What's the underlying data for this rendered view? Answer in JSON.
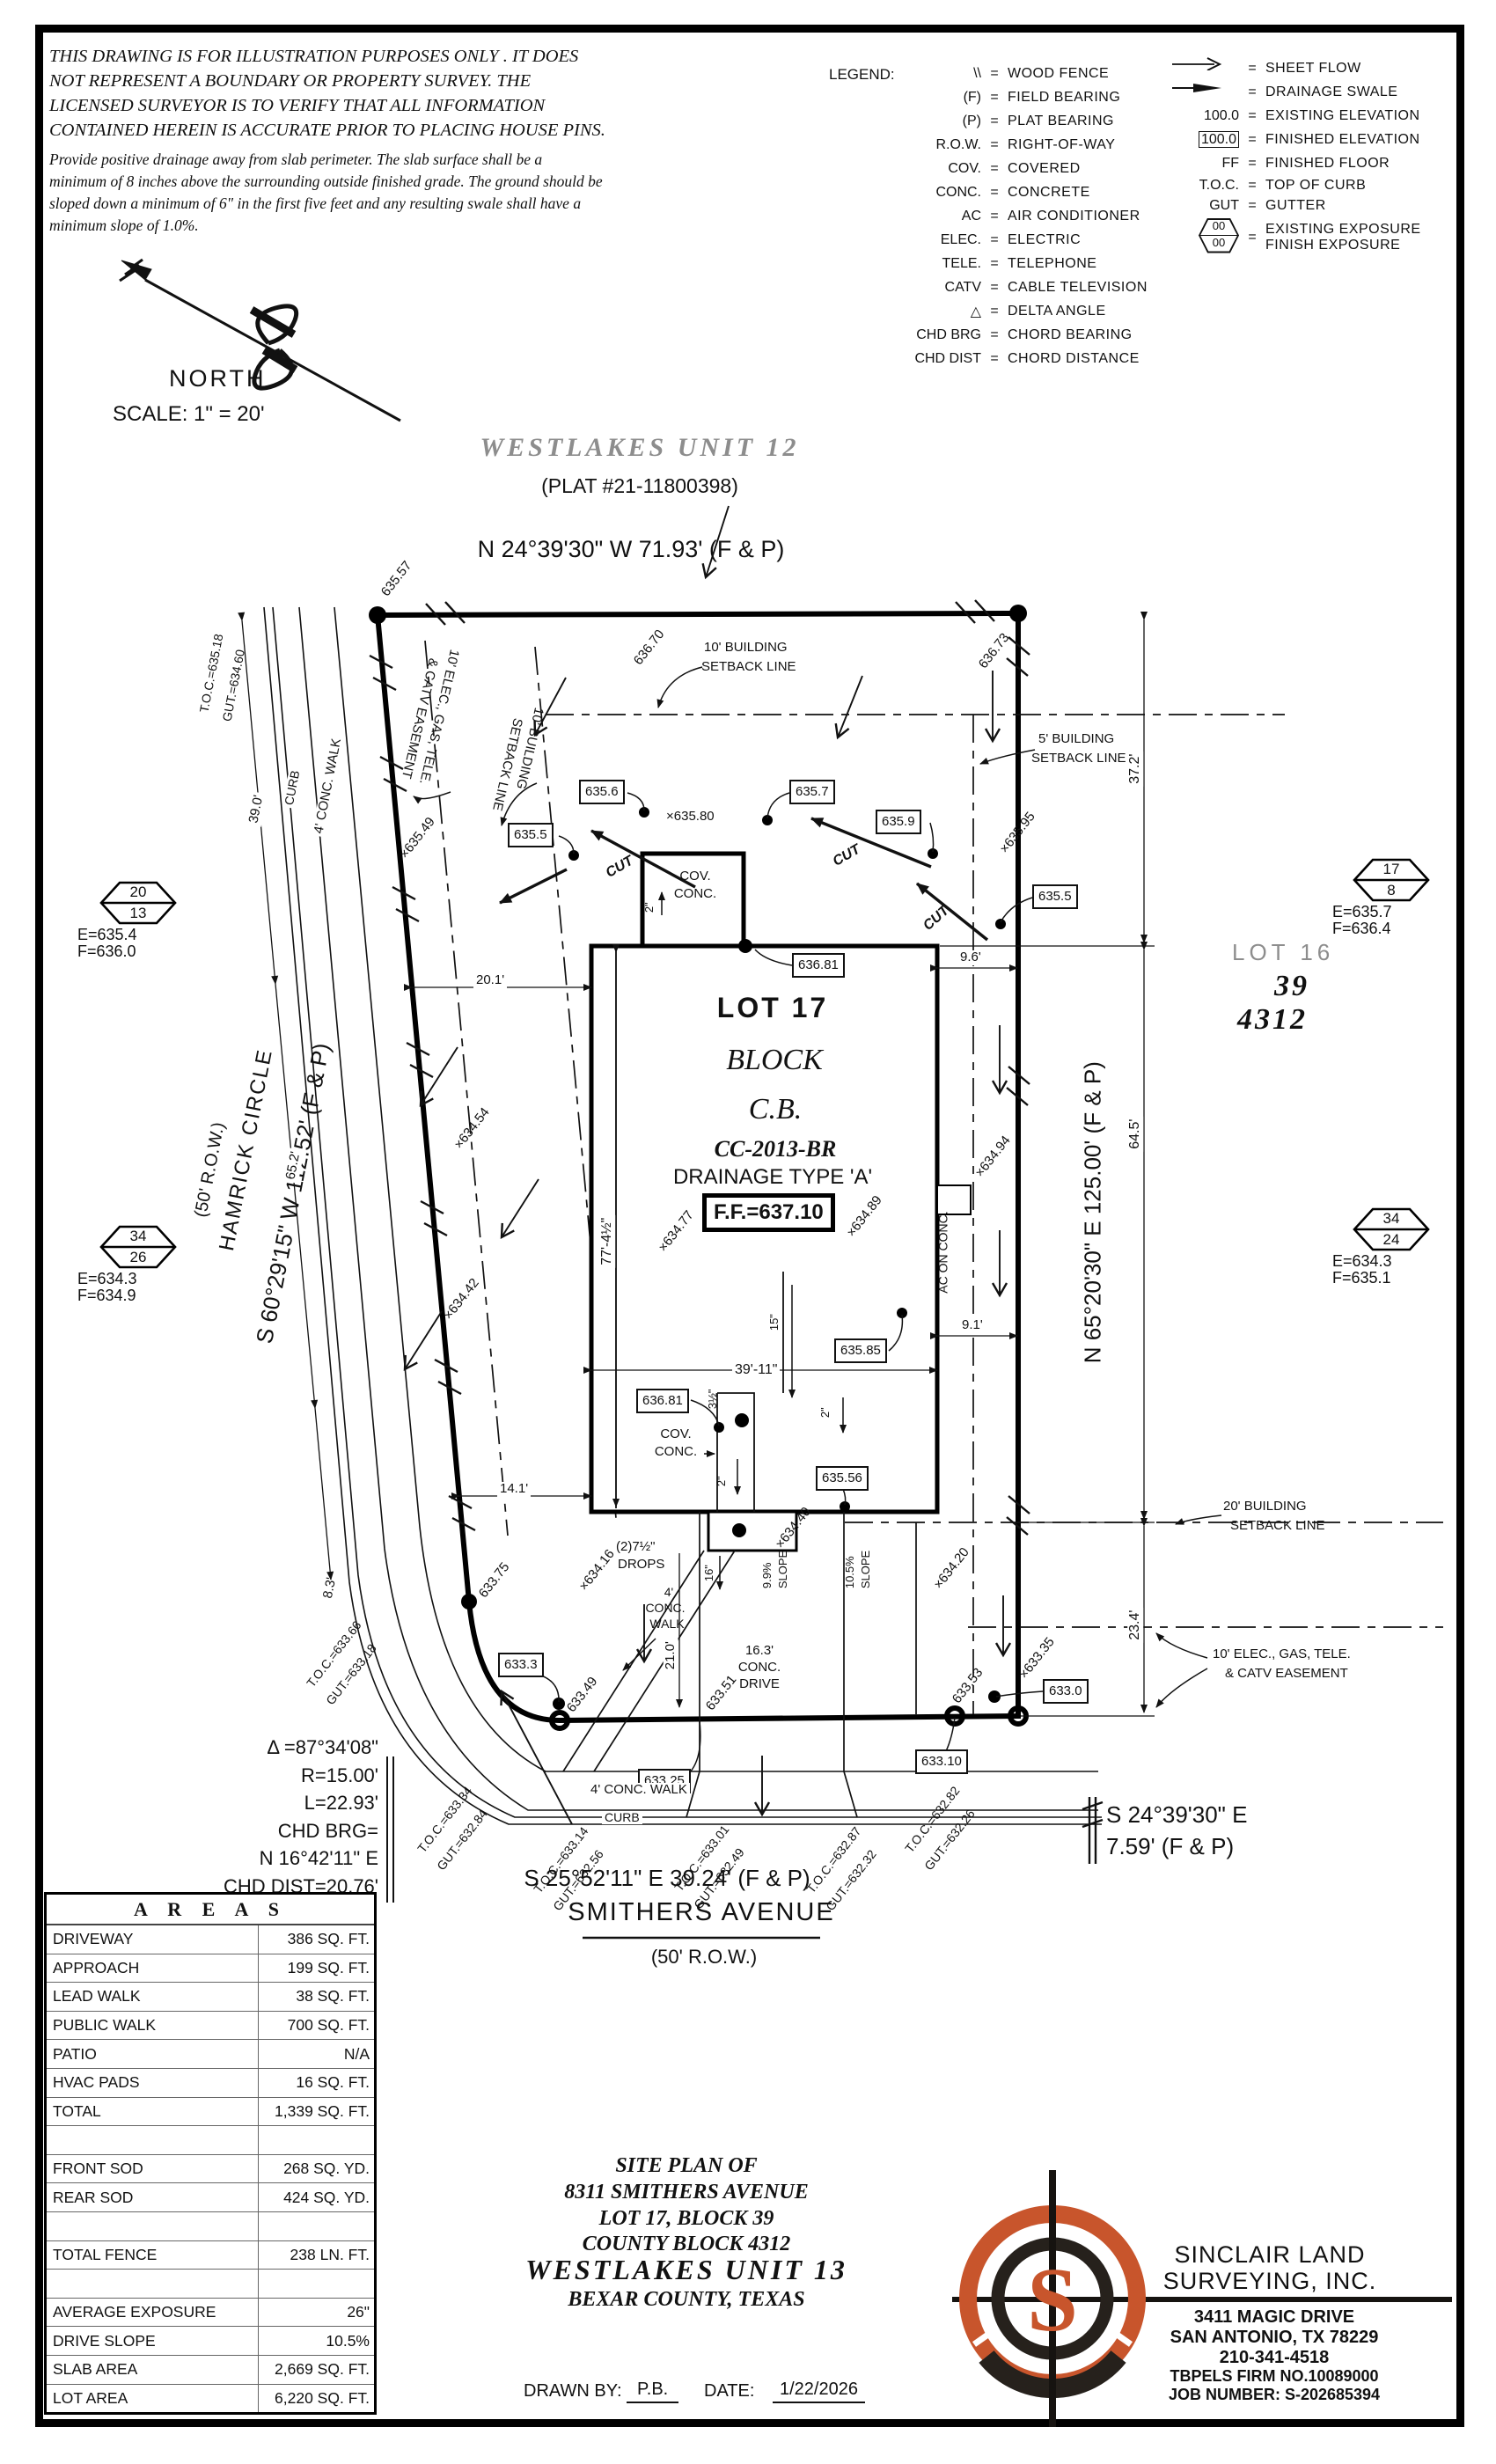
{
  "colors": {
    "accent": "#c8552c",
    "ink": "#111111",
    "gray_text": "#8d8d8d"
  },
  "disclaimer": {
    "lines": [
      "THIS DRAWING IS FOR ILLUSTRATION PURPOSES ONLY . IT DOES",
      "NOT REPRESENT A BOUNDARY OR PROPERTY SURVEY. THE",
      "LICENSED SURVEYOR IS TO VERIFY THAT ALL INFORMATION",
      "CONTAINED HEREIN IS ACCURATE PRIOR TO PLACING HOUSE PINS."
    ],
    "note_lines": [
      "Provide positive drainage away from slab perimeter. The slab surface shall be a",
      "minimum of 8 inches above the surrounding outside finished grade. The ground should be",
      "sloped down a minimum of 6\" in the first five feet and any resulting swale shall have a",
      "minimum slope of 1.0%."
    ]
  },
  "north": {
    "label": "NORTH",
    "scale": "SCALE: 1\" = 20'"
  },
  "legend": {
    "title": "LEGEND:",
    "eq": "=",
    "left": [
      {
        "sym": "\\\\",
        "desc": "WOOD FENCE"
      },
      {
        "sym": "(F)",
        "desc": "FIELD BEARING"
      },
      {
        "sym": "(P)",
        "desc": "PLAT BEARING"
      },
      {
        "sym": "R.O.W.",
        "desc": "RIGHT-OF-WAY"
      },
      {
        "sym": "COV.",
        "desc": "COVERED"
      },
      {
        "sym": "CONC.",
        "desc": "CONCRETE"
      },
      {
        "sym": "AC",
        "desc": "AIR CONDITIONER"
      },
      {
        "sym": "ELEC.",
        "desc": "ELECTRIC"
      },
      {
        "sym": "TELE.",
        "desc": "TELEPHONE"
      },
      {
        "sym": "CATV",
        "desc": "CABLE TELEVISION"
      },
      {
        "sym": "△",
        "desc": "DELTA ANGLE"
      },
      {
        "sym": "CHD BRG",
        "desc": "CHORD BEARING"
      },
      {
        "sym": "CHD DIST",
        "desc": "CHORD DISTANCE"
      }
    ],
    "right": [
      {
        "desc": "SHEET FLOW"
      },
      {
        "desc": "DRAINAGE SWALE"
      },
      {
        "sym": "100.0",
        "desc": "EXISTING ELEVATION"
      },
      {
        "sym": "100.0",
        "desc": "FINISHED ELEVATION"
      },
      {
        "sym": "FF",
        "desc": "FINISHED FLOOR"
      },
      {
        "sym": "T.O.C.",
        "desc": "TOP OF CURB"
      },
      {
        "sym": "GUT",
        "desc": "GUTTER"
      },
      {
        "sym_top": "00",
        "sym_bottom": "00",
        "desc1": "EXISTING EXPOSURE",
        "desc2": "FINISH EXPOSURE"
      }
    ]
  },
  "header": {
    "subdivision": "WESTLAKES UNIT 12",
    "plat": "(PLAT #21-11800398)",
    "bearing_top": "N 24°39'30\" W 71.93' (F & P)"
  },
  "west_street": {
    "name": "HAMRICK CIRCLE",
    "row": "(50' R.O.W.)",
    "bearing": "S 60°29'15\" W 112.52' (F & P)"
  },
  "east_bearing": "N 65°20'30\" E 125.00' (F & P)",
  "south_street": {
    "bearing": "S 25°52'11\" E 39.24' (F & P)",
    "name": "SMITHERS AVENUE",
    "row": "(50' R.O.W.)"
  },
  "se_bearing": {
    "line1": "S 24°39'30\" E",
    "line2": "7.59' (F & P)"
  },
  "curve": {
    "delta": "Δ =87°34'08\"",
    "radius": "R=15.00'",
    "length": "L=22.93'",
    "chd_brg_label": "CHD BRG=",
    "chd_brg": "N 16°42'11\" E",
    "chd_dist": "CHD DIST=20.76'"
  },
  "lot17": {
    "name": "LOT 17",
    "block": "BLOCK",
    "cb": "C.B.",
    "plan_code": "CC-2013-BR",
    "drainage": "DRAINAGE TYPE 'A'",
    "finished_floor": "F.F.=637.10"
  },
  "lot16": {
    "name": "LOT 16",
    "block": "39",
    "cb": "4312"
  },
  "markers": [
    {
      "top": "20",
      "bottom": "13",
      "existing": "E=635.4",
      "finish": "F=636.0"
    },
    {
      "top": "34",
      "bottom": "26",
      "existing": "E=634.3",
      "finish": "F=634.9"
    },
    {
      "top": "17",
      "bottom": "8",
      "existing": "E=635.7",
      "finish": "F=636.4"
    },
    {
      "top": "34",
      "bottom": "24",
      "existing": "E=634.3",
      "finish": "F=635.1"
    }
  ],
  "finished_spots": {
    "a635_6": "635.6",
    "a635_5l": "635.5",
    "a635_7": "635.7",
    "a635_9": "635.9",
    "a635_5r": "635.5",
    "a636_81t": "636.81",
    "a635_85": "635.85",
    "a636_81b": "636.81",
    "a635_56": "635.56",
    "a633_3": "633.3",
    "a633_25": "633.25",
    "a633_0": "633.0",
    "a633_10": "633.10"
  },
  "existing_spots": {
    "e635_57": "635.57",
    "e636_70": "636.70",
    "e636_73": "636.73",
    "e635_80": "×635.80",
    "e635_95": "×635.95",
    "e635_49": "×635.49",
    "e634_54": "×634.54",
    "e634_42": "×634.42",
    "e634_77": "×634.77",
    "e634_89": "×634.89",
    "e634_94": "×634.94",
    "e634_16": "×634.16",
    "e634_40": "×634.40",
    "e634_20": "×634.20",
    "e633_75": "633.75",
    "e633_53": "633.53",
    "e633_35": "×633.35",
    "e633_49": "633.49",
    "e633_51": "633.51"
  },
  "toc": {
    "t1": {
      "toc": "T.O.C.=635.18",
      "gut": "GUT.=634.60"
    },
    "t2": {
      "toc": "T.O.C.=633.66",
      "gut": "GUT.=633.18"
    },
    "t3": {
      "toc": "T.O.C.=633.34",
      "gut": "GUT.=632.84"
    },
    "t4": {
      "toc": "T.O.C.=633.14",
      "gut": "GUT.=632.56"
    },
    "t5": {
      "toc": "T.O.C.=633.01",
      "gut": "GUT.=632.49"
    },
    "t6": {
      "toc": "T.O.C.=632.87",
      "gut": "GUT.=632.32"
    },
    "t7": {
      "toc": "T.O.C.=632.82",
      "gut": "GUT.=632.26"
    }
  },
  "dims": {
    "d37_2": "37.2'",
    "d64_5": "64.5'",
    "d23_4": "23.4'",
    "d9_6": "9.6'",
    "d9_1": "9.1'",
    "d20_1": "20.1'",
    "d14_1": "14.1'",
    "d8_3": "8.3'",
    "d39_0": "39.0'",
    "d65_2": "65.2'",
    "d77": "77'-4½\"",
    "d39_11": "39'-11\"",
    "d15": "15\"",
    "d16": "16\"",
    "d21_0": "21.0'",
    "d2": "2\"",
    "d3h": "3½\"",
    "drops1": "(2)7½\"",
    "drops2": "DROPS",
    "drive1": "16.3'",
    "drive2": "CONC.",
    "drive3": "DRIVE",
    "slope99": "9.9%",
    "slope105": "10.5%",
    "slope_word": "SLOPE"
  },
  "labels": {
    "setback10_1": "10' BUILDING",
    "setback10_2": "SETBACK LINE",
    "setback5_1": "5' BUILDING",
    "setback5_2": "SETBACK LINE",
    "setback20_1": "20' BUILDING",
    "setback20_2": "SETBACK LINE",
    "easement_1": "10' ELEC., GAS, TELE.",
    "easement_2": "& CATV EASEMENT",
    "cov": "COV.",
    "conc": "CONC.",
    "cut": "CUT",
    "ac_on_conc": "AC ON CONC.",
    "walk4": "4' CONC. WALK",
    "curb": "CURB",
    "walk4_1": "4'",
    "walk4_2": "CONC.",
    "walk4_3": "WALK"
  },
  "areas": {
    "title": "A R E A S",
    "rows": [
      [
        "DRIVEWAY",
        "386 SQ. FT."
      ],
      [
        "APPROACH",
        "199 SQ. FT."
      ],
      [
        "LEAD WALK",
        "38 SQ. FT."
      ],
      [
        "PUBLIC WALK",
        "700 SQ. FT."
      ],
      [
        "PATIO",
        "N/A"
      ],
      [
        "HVAC PADS",
        "16 SQ. FT."
      ],
      [
        "TOTAL",
        "1,339 SQ. FT."
      ],
      [
        "",
        ""
      ],
      [
        "FRONT SOD",
        "268 SQ. YD."
      ],
      [
        "REAR SOD",
        "424 SQ. YD."
      ],
      [
        "",
        ""
      ],
      [
        "TOTAL FENCE",
        "238 LN. FT."
      ],
      [
        "",
        ""
      ],
      [
        "AVERAGE EXPOSURE",
        "26\""
      ],
      [
        "DRIVE SLOPE",
        "10.5%"
      ],
      [
        "SLAB AREA",
        "2,669 SQ. FT."
      ],
      [
        "LOT AREA",
        "6,220 SQ. FT."
      ]
    ]
  },
  "titleblock": {
    "l1": "SITE PLAN OF",
    "l2": "8311 SMITHERS AVENUE",
    "l3": "LOT 17, BLOCK 39",
    "l4": "COUNTY BLOCK 4312",
    "l5": "WESTLAKES UNIT 13",
    "l6": "BEXAR COUNTY, TEXAS",
    "drawn_label": "DRAWN BY:",
    "drawn_by": "P.B.",
    "date_label": "DATE:",
    "date": "1/22/2026"
  },
  "company": {
    "logo_letter": "S",
    "name1": "SINCLAIR LAND",
    "name2": "SURVEYING, INC.",
    "address1": "3411 MAGIC DRIVE",
    "address2": "SAN ANTONIO, TX 78229",
    "phone": "210-341-4518",
    "firm": "TBPELS FIRM NO.10089000",
    "job": "JOB NUMBER: S-202685394"
  }
}
